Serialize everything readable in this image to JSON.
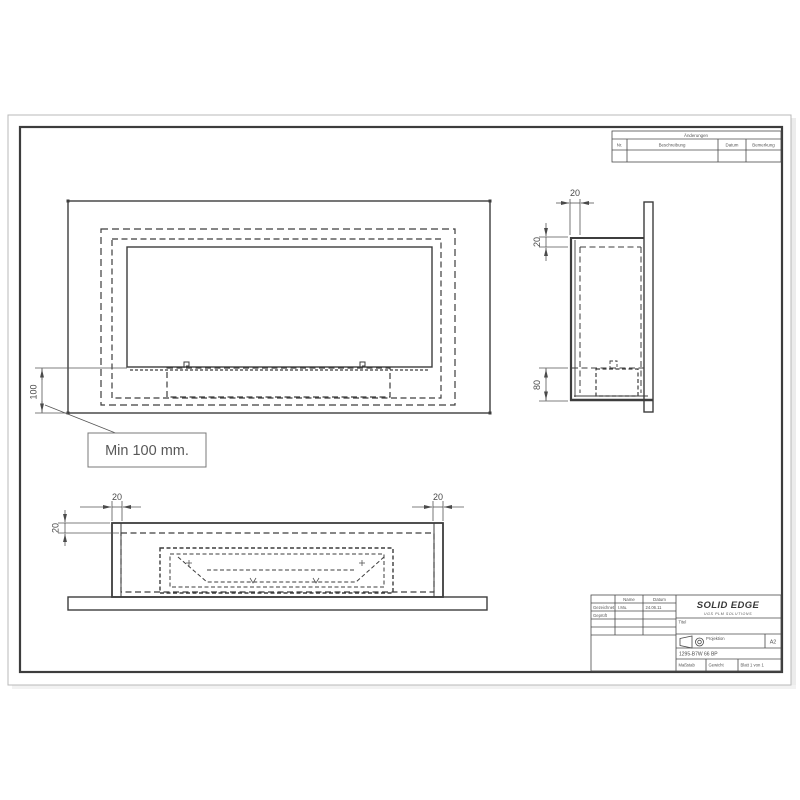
{
  "revision_table": {
    "title": "Änderungen",
    "col_nr": "Nr.",
    "col_desc": "Beschreibung",
    "col_date": "Datum",
    "col_note": "Bemerkung"
  },
  "views": {
    "front": {
      "dim_wall_offset": "100",
      "label_min": "Min 100 mm."
    },
    "side": {
      "dim_depth": "20",
      "dim_top_offset": "20",
      "dim_bottom_height": "80"
    },
    "bottom": {
      "dim_left_wall": "20",
      "dim_right_wall": "20",
      "dim_front_wall": "20"
    }
  },
  "title_block": {
    "logo": "SOLID EDGE",
    "logo_sub": "UGS PLM SOLUTIONS",
    "col_name": "Name",
    "col_date": "Datum",
    "row_drawn_label": "Gezeichnet",
    "row_drawn_name": "I.Mu.",
    "row_drawn_date": "24.06.11",
    "row_checked_label": "Geprüft",
    "title_label": "Titel",
    "projection_label": "Projektion",
    "sheet_size": "A2",
    "doc_number": "1295-B7W 66 BP",
    "scale_label": "Maßstab",
    "weight_label": "Gewicht",
    "sheet_label": "Blatt 1 von 1"
  }
}
